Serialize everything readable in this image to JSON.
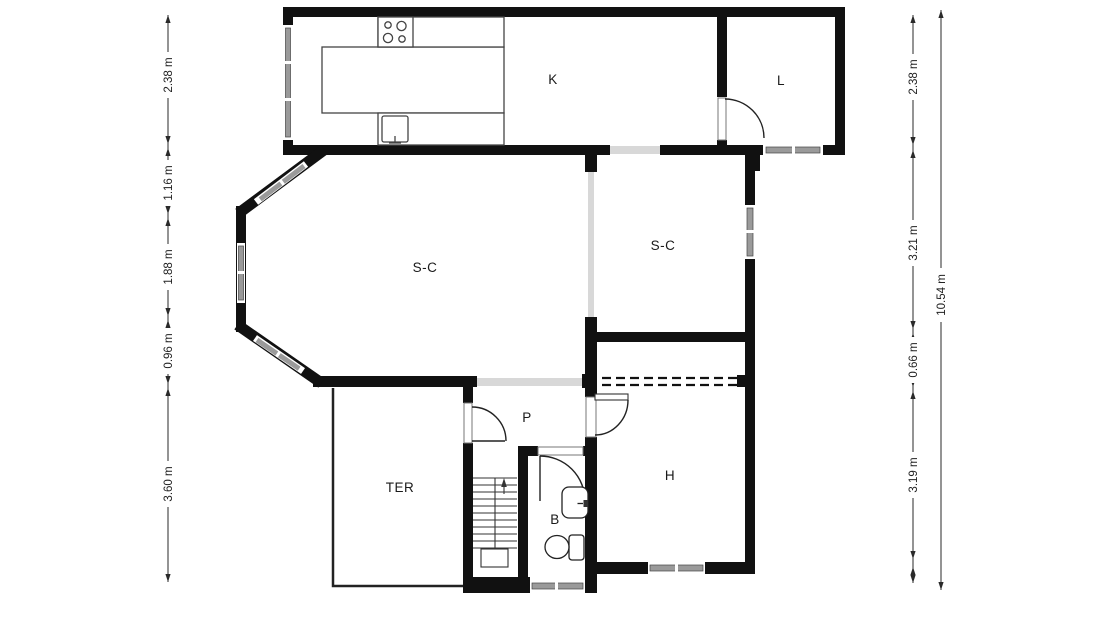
{
  "plan": {
    "room_labels": {
      "k": "K",
      "l": "L",
      "sc_left": "S-C",
      "sc_right": "S-C",
      "p": "P",
      "ter": "TER",
      "b": "B",
      "h": "H"
    }
  },
  "dimensions": {
    "left": [
      "2.38 m",
      "1.16 m",
      "1.88 m",
      "0.96 m",
      "3.60 m"
    ],
    "right": [
      "2.38 m",
      "3.21 m",
      "0.66 m",
      "3.19 m"
    ],
    "total": "10.54 m"
  },
  "colors": {
    "wall": "#111111",
    "window_glass": "#9a9a9a",
    "opening": "#d8d8d8",
    "dimension_line": "#2a2a2a",
    "background": "#ffffff"
  }
}
